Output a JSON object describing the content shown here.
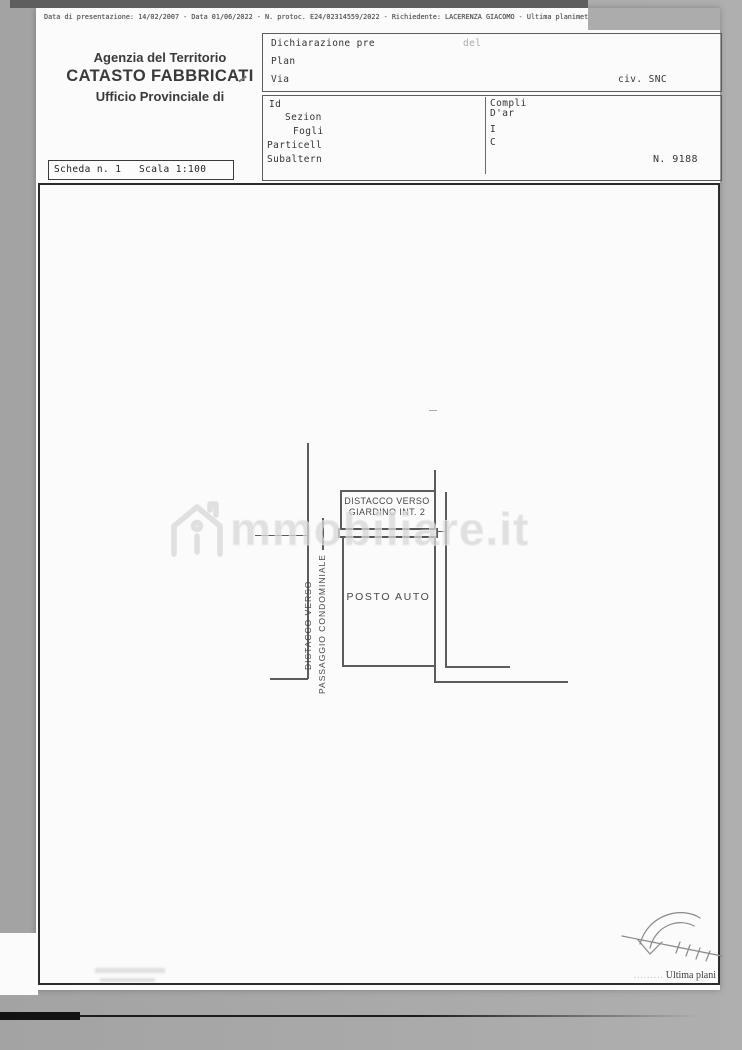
{
  "scan": {
    "top_meta_line": "Data di presentazione: 14/02/2007 - Data 01/06/2022 - N. protoc. E24/02314559/2022 - Richiedente: LACERENZA GIACOMO - Ultima planimetria in atti",
    "bottom_right_prefix": "……… ",
    "bottom_right_text": "Ultima plani"
  },
  "header": {
    "agency": "Agenzia del Territorio",
    "registry": "CATASTO FABBRICATI",
    "office": "Ufficio Provinciale di"
  },
  "declaration_box": {
    "row1_label": "Dichiarazione pre",
    "row1_faint": "del",
    "row2_label": "Plan",
    "row3_label": "Via",
    "row3_right": "civ. SNC"
  },
  "identifiers_box": {
    "label_id": "Id",
    "label_sezione": "Sezion",
    "label_foglio": "Fogli",
    "label_particella": "Particell",
    "label_subalterno": "Subaltern",
    "right_line1": "Compli",
    "right_line2": "D'ar",
    "right_line3": "I",
    "right_line4": "C",
    "sheet_number": "N. 9188"
  },
  "scheda_box": {
    "scheda": "Scheda n. 1",
    "scala": "Scala 1:100"
  },
  "plan": {
    "posto_auto": "POSTO AUTO",
    "giardino_line1": "DISTACCO VERSO",
    "giardino_line2": "GIARDINO INT. 2",
    "left_line1": "DISTACCO VERSO",
    "left_line2": "PASSAGGIO CONDOMINIALE"
  },
  "watermark": {
    "text": "mmobiliare.it",
    "icon": "immobiliare-house-logo",
    "color": "#d7d7d7"
  },
  "colors": {
    "page": "#fbfbfb",
    "scan_background": "#a8a8a8",
    "ink": "#343434",
    "plan_line": "#5c5c5c"
  }
}
